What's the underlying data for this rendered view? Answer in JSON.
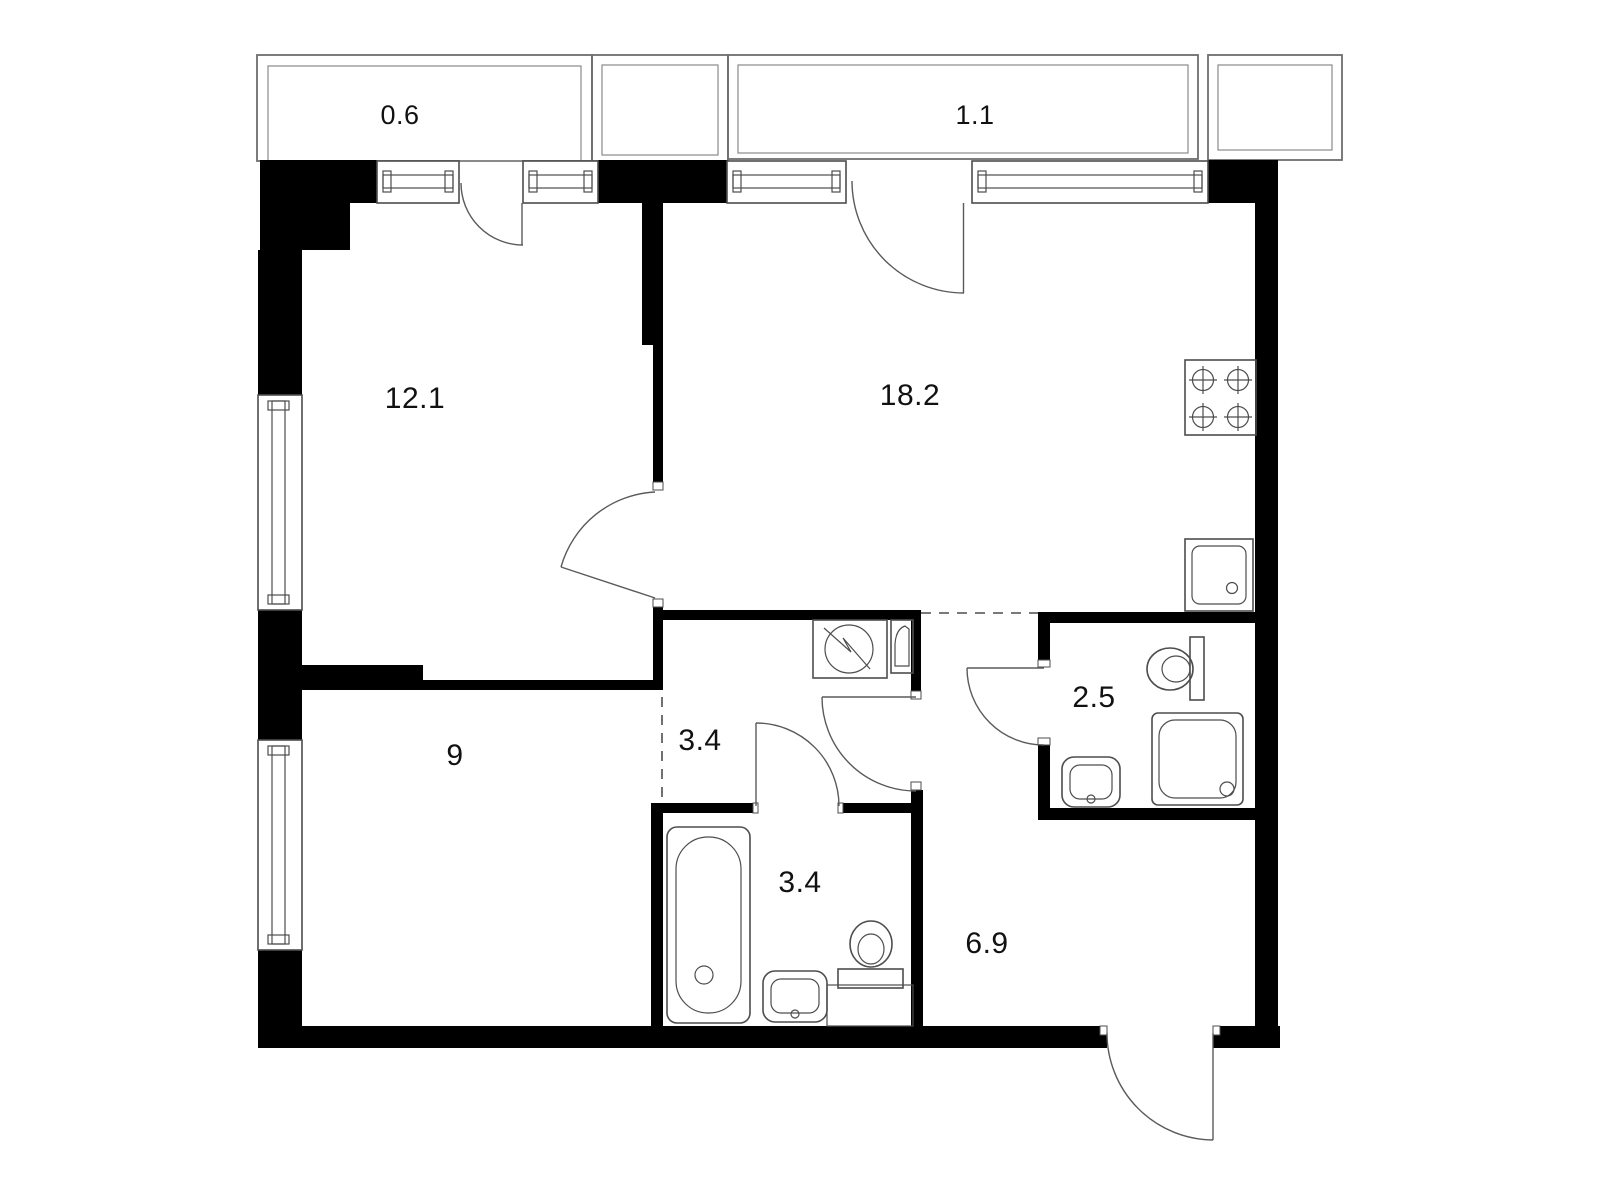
{
  "plan": {
    "type": "apartment-floor-plan",
    "background": "#ffffff",
    "wall_color": "#000000",
    "line_color": "#4d4d4d",
    "rooms": [
      {
        "id": "living-room",
        "area_label": "12.1"
      },
      {
        "id": "kitchen-living",
        "area_label": "18.2"
      },
      {
        "id": "bedroom",
        "area_label": "9"
      },
      {
        "id": "hallway",
        "area_label": "3.4"
      },
      {
        "id": "bathroom",
        "area_label": "3.4"
      },
      {
        "id": "shower-room",
        "area_label": "2.5"
      },
      {
        "id": "corridor",
        "area_label": "6.9"
      }
    ],
    "balconies": [
      {
        "id": "balcony-left",
        "area_label": "0.6"
      },
      {
        "id": "balcony-right",
        "area_label": "1.1"
      }
    ],
    "fixtures": [
      "stove-icon",
      "kitchen-sink-icon",
      "washing-machine-icon",
      "electrical-panel-icon",
      "bathtub-icon",
      "bathroom-sink-icon",
      "toilet-icon",
      "shower-tray-icon",
      "shower-sink-icon",
      "shower-toilet-icon"
    ]
  }
}
